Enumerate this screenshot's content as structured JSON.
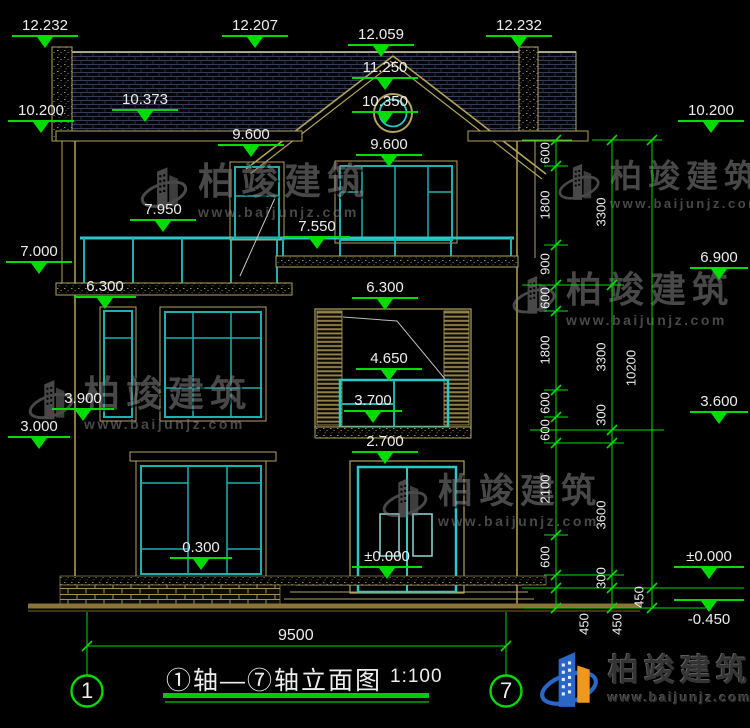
{
  "drawing": {
    "title": "①轴—⑦轴立面图",
    "scale": "1:100",
    "axis_start": "1",
    "axis_end": "7",
    "overall_width_dim": "9500"
  },
  "markers": [
    {
      "id": "roof-left-top",
      "value": "12.232"
    },
    {
      "id": "roof-mid-left-top",
      "value": "12.207"
    },
    {
      "id": "gable-apex",
      "value": "12.059"
    },
    {
      "id": "roof-right-top",
      "value": "12.232"
    },
    {
      "id": "eave-left",
      "value": "10.200"
    },
    {
      "id": "roof-left-slope",
      "value": "10.373"
    },
    {
      "id": "gable-ridge",
      "value": "11.250"
    },
    {
      "id": "round-window",
      "value": "10.350"
    },
    {
      "id": "eave-right",
      "value": "10.200"
    },
    {
      "id": "window3f-left-top",
      "value": "9.600"
    },
    {
      "id": "window3f-mid-top",
      "value": "9.600"
    },
    {
      "id": "balcony-left-rail",
      "value": "7.950"
    },
    {
      "id": "balcony-right-rail",
      "value": "7.550"
    },
    {
      "id": "balcony-left-slab",
      "value": "7.000"
    },
    {
      "id": "floor3-right",
      "value": "6.900"
    },
    {
      "id": "window2f-left-top",
      "value": "6.300"
    },
    {
      "id": "window2f-mid-top",
      "value": "6.300"
    },
    {
      "id": "window2f-mid-sash",
      "value": "4.650"
    },
    {
      "id": "window2f-left-sill",
      "value": "3.900"
    },
    {
      "id": "window2f-mid-sill",
      "value": "3.700"
    },
    {
      "id": "bay-roof-left",
      "value": "3.000"
    },
    {
      "id": "door-top",
      "value": "2.700"
    },
    {
      "id": "floor2-right",
      "value": "3.600"
    },
    {
      "id": "window1f-left-sill",
      "value": "0.300"
    },
    {
      "id": "ground-mid",
      "value": "±0.000"
    },
    {
      "id": "ground-right",
      "value": "±0.000"
    },
    {
      "id": "foundation-right",
      "value": "-0.450"
    }
  ],
  "dim_chains": {
    "inner": [
      "600",
      "1800",
      "900",
      "600",
      "1800",
      "600",
      "600",
      "2100",
      "600",
      "450"
    ],
    "middle": [
      "3300",
      "3300",
      "300",
      "3600",
      "300",
      "450"
    ],
    "outer": [
      "10200",
      "450"
    ]
  },
  "watermark": {
    "name": "柏竣建筑",
    "url": "www.baijunjz.com"
  },
  "logo": {
    "name": "柏竣建筑",
    "url": "www.baijunjz.com"
  },
  "colors": {
    "dimension_green": "#00dc00",
    "frame_cyan": "#1db0b0",
    "outline_tan": "#b4a35c",
    "logo_blue": "#2a66c8",
    "logo_orange": "#f0971e"
  }
}
